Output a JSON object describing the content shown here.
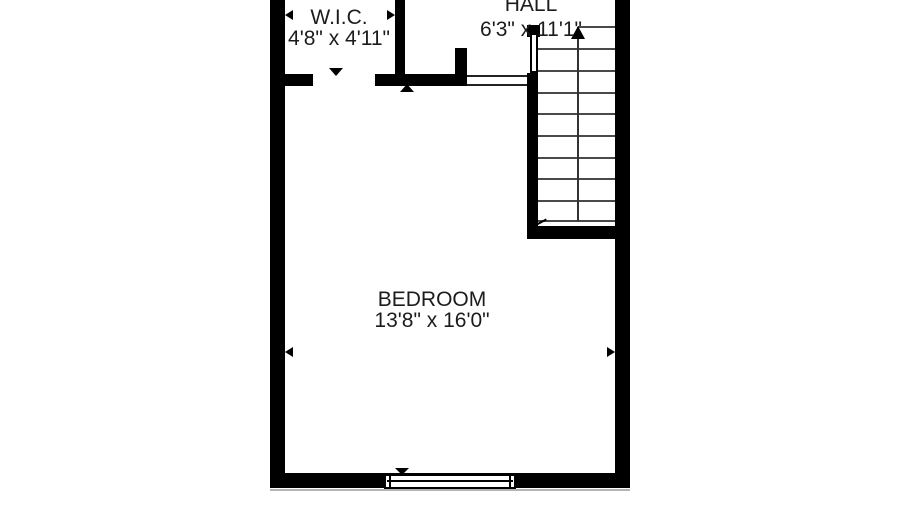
{
  "plan_title": "floor-plan",
  "rooms": {
    "wic": {
      "name": "W.I.C.",
      "dimensions": "4'8\" x 4'11\""
    },
    "hall": {
      "name": "HALL",
      "dimensions": "6'3\" x 11'1\""
    },
    "bedroom": {
      "name": "BEDROOM",
      "dimensions": "13'8\" x 16'0\""
    }
  },
  "stairs": {
    "direction": "up",
    "tread_lines": 10
  },
  "colors": {
    "wall": "#000000",
    "text": "#1c1c1c",
    "stair_tread": "#4a4a4a",
    "background": "#ffffff"
  }
}
